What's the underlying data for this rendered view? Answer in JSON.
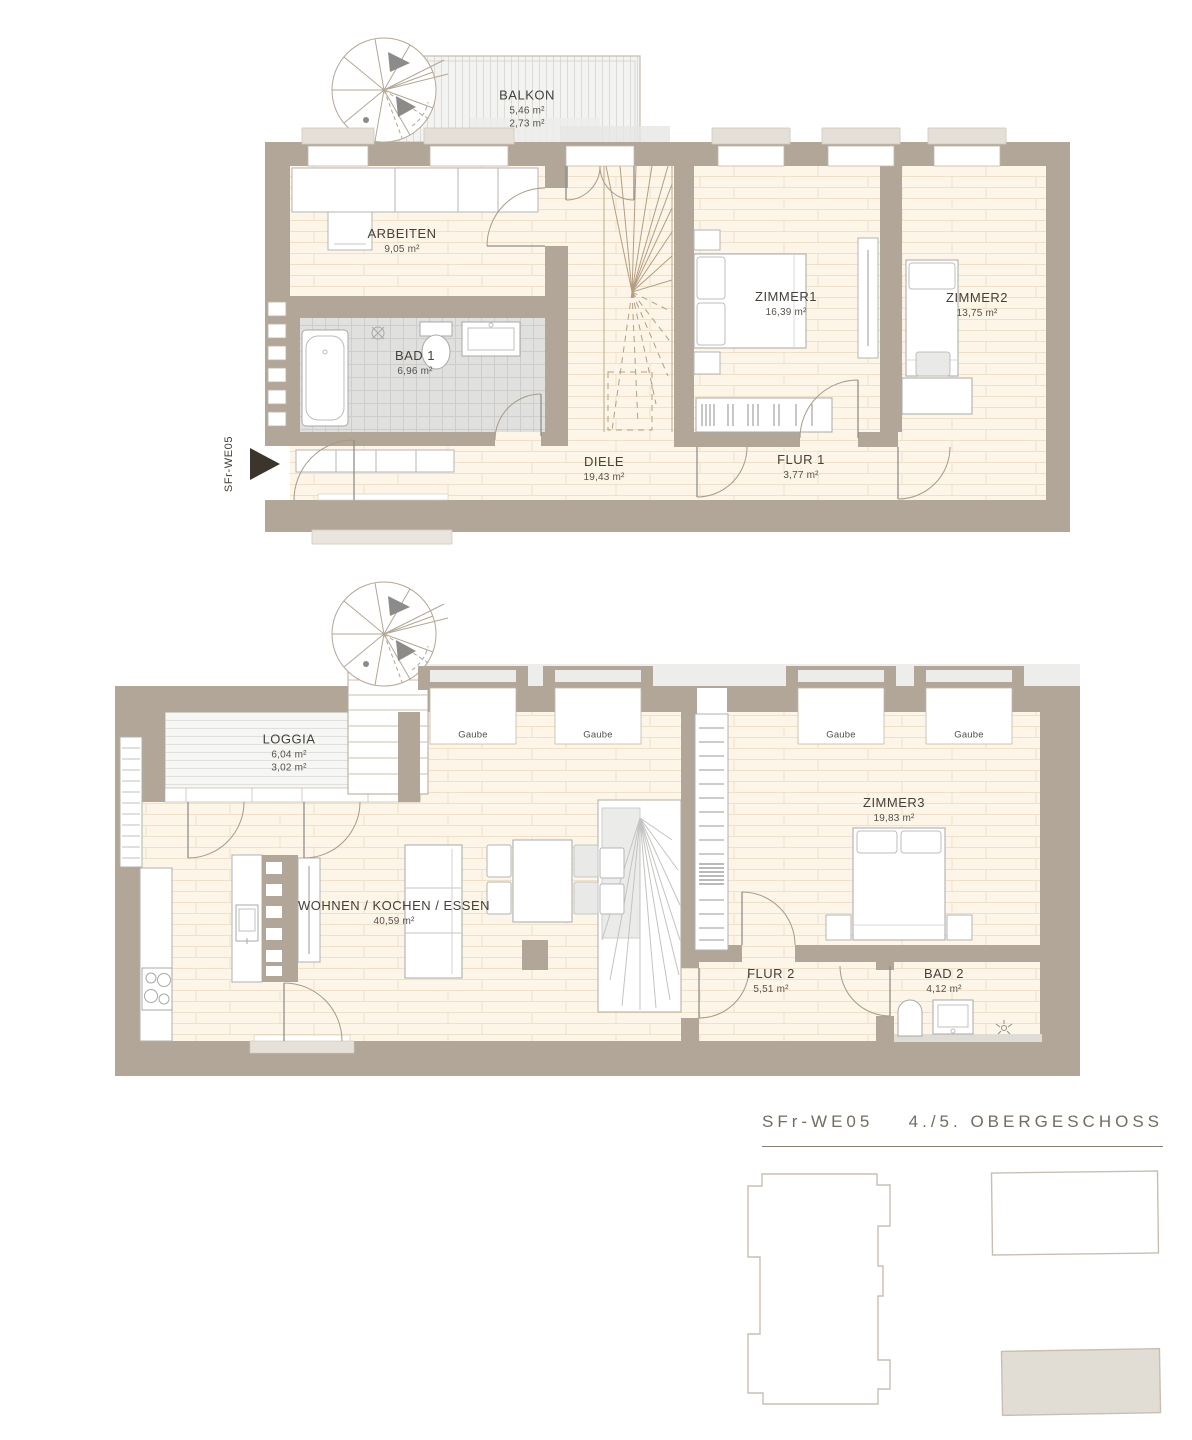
{
  "palette": {
    "wall": "#b1a698",
    "floor": "#fcf5e8",
    "tile": "#e0e0df",
    "title_text": "#756c61",
    "label_text": "#46403a",
    "keyplan_fill": "#e1ddd4"
  },
  "upper_floor": {
    "balkon": {
      "name": "BALKON",
      "area1": "5,46 m²",
      "area2": "2,73 m²"
    },
    "arbeiten": {
      "name": "ARBEITEN",
      "area": "9,05 m²"
    },
    "bad1": {
      "name": "BAD 1",
      "area": "6,96 m²"
    },
    "zimmer1": {
      "name": "ZIMMER1",
      "area": "16,39 m²"
    },
    "zimmer2": {
      "name": "ZIMMER2",
      "area": "13,75 m²"
    },
    "diele": {
      "name": "DIELE",
      "area": "19,43 m²"
    },
    "flur1": {
      "name": "FLUR 1",
      "area": "3,77 m²"
    }
  },
  "lower_floor": {
    "loggia": {
      "name": "LOGGIA",
      "area1": "6,04 m²",
      "area2": "3,02 m²"
    },
    "wohnen": {
      "name": "WOHNEN / KOCHEN / ESSEN",
      "area": "40,59 m²"
    },
    "zimmer3": {
      "name": "ZIMMER3",
      "area": "19,83 m²"
    },
    "flur2": {
      "name": "FLUR 2",
      "area": "5,51 m²"
    },
    "bad2": {
      "name": "BAD 2",
      "area": "4,12 m²"
    },
    "gaube_label": "Gaube"
  },
  "entrance": {
    "label": "SFr-WE05"
  },
  "titleblock": {
    "unit": "SFr-WE05",
    "floor": "4./5. OBERGESCHOSS"
  }
}
